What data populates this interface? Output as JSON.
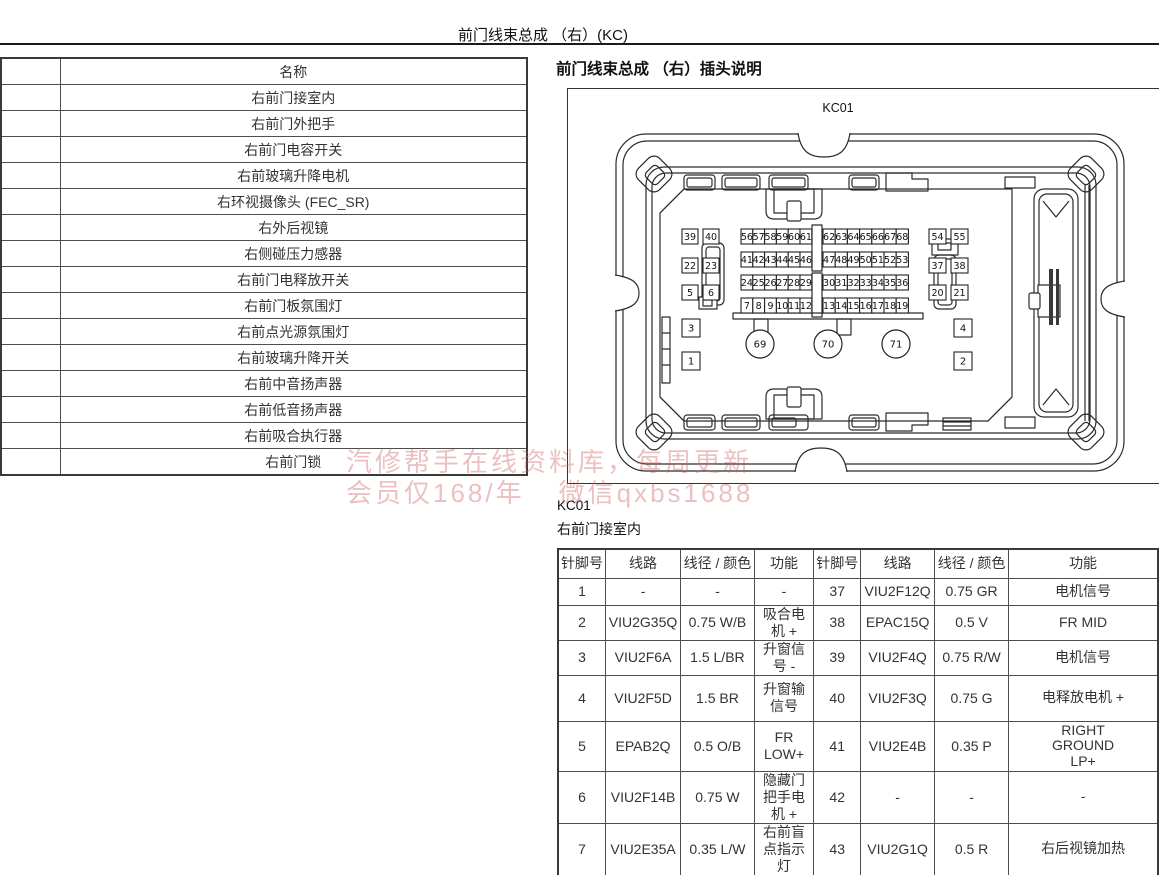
{
  "page": {
    "title": "前门线束总成 （右）(KC)"
  },
  "left_table": {
    "header": "名称",
    "rows": [
      "右前门接室内",
      "右前门外把手",
      "右前门电容开关",
      "右前玻璃升降电机",
      "右环视摄像头 (FEC_SR)",
      "右外后视镜",
      "右侧碰压力感器",
      "右前门电释放开关",
      "右前门板氛围灯",
      "右前点光源氛围灯",
      "右前玻璃升降开关",
      "右前中音扬声器",
      "右前低音扬声器",
      "右前吸合执行器",
      "右前门锁"
    ]
  },
  "section": {
    "heading": "前门线束总成 （右）插头说明",
    "connector_inner_label": "KC01",
    "figure_code": "KC01",
    "figure_location": "右前门接室内"
  },
  "connector": {
    "grid_rows": [
      {
        "left": [
          "56",
          "57",
          "58",
          "59",
          "60",
          "61"
        ],
        "right": [
          "62",
          "63",
          "64",
          "65",
          "66",
          "67",
          "68"
        ]
      },
      {
        "left": [
          "41",
          "42",
          "43",
          "44",
          "45",
          "46"
        ],
        "right": [
          "47",
          "48",
          "49",
          "50",
          "51",
          "52",
          "53"
        ]
      },
      {
        "left": [
          "24",
          "25",
          "26",
          "27",
          "28",
          "29"
        ],
        "right": [
          "30",
          "31",
          "32",
          "33",
          "34",
          "35",
          "36"
        ]
      },
      {
        "left": [
          "7",
          "8",
          "9",
          "10",
          "11",
          "12"
        ],
        "right": [
          "13",
          "14",
          "15",
          "16",
          "17",
          "18",
          "19"
        ]
      }
    ],
    "left_pairs": [
      [
        "39",
        "40"
      ],
      [
        "22",
        "23"
      ],
      [
        "5",
        "6"
      ]
    ],
    "right_pairs": [
      [
        "54",
        "55"
      ],
      [
        "37",
        "38"
      ],
      [
        "20",
        "21"
      ]
    ],
    "left_single": [
      "3",
      "1"
    ],
    "right_single": [
      "4",
      "2"
    ],
    "circles": [
      "69",
      "70",
      "71"
    ]
  },
  "pin_table": {
    "headers": [
      "针脚号",
      "线路",
      "线径 / 颜色",
      "功能",
      "针脚号",
      "线路",
      "线径 / 颜色",
      "功能"
    ],
    "rows": [
      [
        "1",
        "-",
        "-",
        "-",
        "37",
        "VIU2F12Q",
        "0.75 GR",
        "电机信号"
      ],
      [
        "2",
        "VIU2G35Q",
        "0.75 W/B",
        "吸合电机 +",
        "38",
        "EPAC15Q",
        "0.5 V",
        "FR MID"
      ],
      [
        "3",
        "VIU2F6A",
        "1.5 L/BR",
        "升窗信号 -",
        "39",
        "VIU2F4Q",
        "0.75 R/W",
        "电机信号"
      ],
      [
        "4",
        "VIU2F5D",
        "1.5 BR",
        "升窗输信号",
        "40",
        "VIU2F3Q",
        "0.75 G",
        "电释放电机 +"
      ],
      [
        "5",
        "EPAB2Q",
        "0.5 O/B",
        "FR LOW+",
        "41",
        "VIU2E4B",
        "0.35 P",
        "RIGHT GROUND LP+"
      ],
      [
        "6",
        "VIU2F14B",
        "0.75 W",
        "隐藏门把手电机 +",
        "42",
        "-",
        "-",
        "-"
      ],
      [
        "7",
        "VIU2E35A",
        "0.35 L/W",
        "右前盲点指示灯",
        "43",
        "VIU2G1Q",
        "0.5 R",
        "右后视镜加热"
      ]
    ]
  },
  "watermark": {
    "line1": "汽修帮手在线资料库，每周更新",
    "line2a": "会员仅168/年",
    "line2b": "微信qxbs1688",
    "color": "rgba(205,90,90,0.38)"
  }
}
